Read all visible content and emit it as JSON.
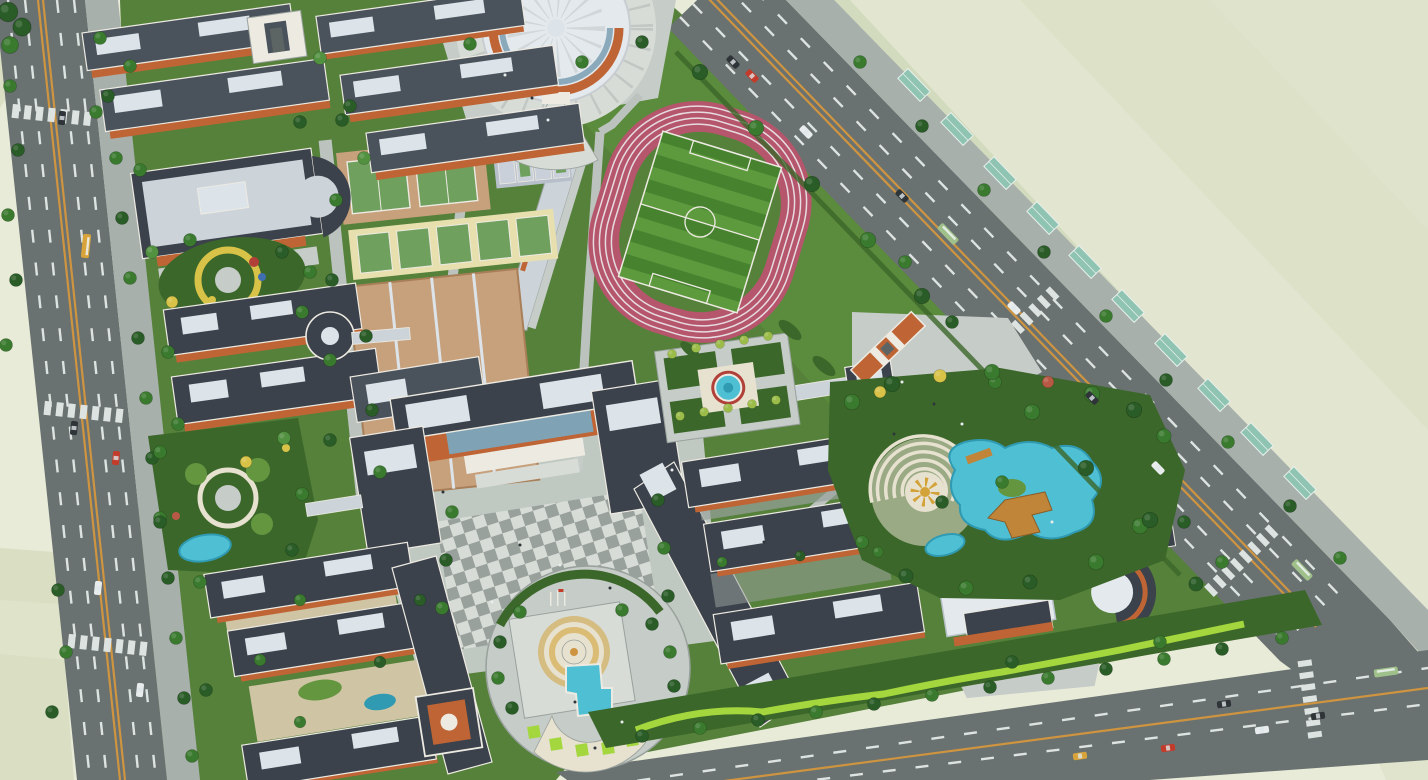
{
  "scene": {
    "type": "aerial architectural rendering",
    "subject": "school campus master plan, bird's-eye oblique view",
    "surroundings": "pale undeveloped fields beyond boundary roads",
    "visible_text": ""
  },
  "palette": {
    "field": "#e9ebd9",
    "fieldA": "#e0e4cc",
    "fieldB": "#dadfc3",
    "fieldG": "#cfd9bb",
    "grass": "#55813a",
    "grassD": "#3c672a",
    "grassB": "#649640",
    "asphalt": "#697270",
    "asphaltD": "#5c6564",
    "dash": "#dde3e0",
    "orange": "#cf9440",
    "sidewalk": "#a8b0ac",
    "sidewalkL": "#bcc3bf",
    "paving": "#c6ccc8",
    "pavingL": "#d8dcd7",
    "pavingD": "#99a19d",
    "roofD": "#3b424b",
    "roofM": "#4a525c",
    "roofL": "#ccd4da",
    "roofW": "#e4e9ed",
    "panel": "#dce3e9",
    "wall": "#bf6535",
    "wallL": "#d98e52",
    "trim": "#edeae2",
    "glass": "#7fa3b5",
    "water": "#4fc0d4",
    "waterD": "#2f9ab2",
    "track": "#b5566d",
    "laneLine": "#e6dce0",
    "pitchA": "#47822f",
    "pitchB": "#5d9a3d",
    "tan": "#c7a07c",
    "tanD": "#a87f58",
    "green": "#6fa05e",
    "blue": "#b7bfca",
    "blueL": "#c9d0da",
    "yellowC": "#e7e0ae",
    "cream": "#e7e1cf",
    "wood": "#c08538",
    "gold": "#d3a339",
    "redAcc": "#b04038",
    "hedge": "#a4d63e",
    "courtyard": "#cfc4a4",
    "bbLine": "#7c4f32",
    "tD": "#295c26",
    "tM": "#3a7a2e",
    "tL": "#529140",
    "tY": "#d8c348",
    "tYg": "#9cbc4a",
    "tR": "#b85946",
    "carR": "#c33b2a",
    "carY": "#d8a33a",
    "carW": "#e8ecec",
    "carD": "#2e3438",
    "bus": "#9fc08a",
    "gh": "#8fc4b2",
    "wht": "#f2f4f2"
  },
  "features": {
    "gymnasium": {
      "name": "round-gymnasium",
      "roof": "white dome with radial ribs",
      "facade_band": "orange"
    },
    "stadium": {
      "name": "running-track",
      "track_color_name": "red",
      "lanes": 6,
      "infield": "striped soccer pitch with white markings"
    },
    "courts": {
      "basketball_courts": 16,
      "tennis_courts": 2,
      "badminton_courts": 5,
      "small_courts": 8,
      "surfaces": {
        "basketball": "tan",
        "tennis": "green on tan apron",
        "badminton": "green on pale yellow",
        "small": "blue-gray"
      }
    },
    "buildings": {
      "style": "orange brick walls, dark slate roofs, white trim",
      "clusters": [
        "north dormitory rows",
        "north gate",
        "canteen with curved annex",
        "west teaching pair with round link",
        "main teaching complex with glass entrance",
        "east E-shaped teaching complex",
        "south dormitory cluster with clock tower",
        "southeast white-roof complex with curved wing",
        "east gate"
      ]
    },
    "gardens": [
      "kindergarten play garden",
      "clover garden with pond",
      "square garden with round pond",
      "amphitheater water garden with sun mosaic and wooden deck",
      "south circular fountain plaza",
      "south green berm with wavy hedge"
    ],
    "roads": {
      "west_road": {
        "orientation": "near-vertical",
        "center_line": "double orange",
        "lane_dashes": "white"
      },
      "northeast_road": {
        "orientation": "diagonal",
        "center_line": "double orange",
        "roadside": "row of teal shelters"
      },
      "south_road": {
        "orientation": "near-horizontal",
        "center_line": "orange"
      }
    },
    "vehicles": {
      "cars": 16,
      "buses": 5
    },
    "flagpoles": 3
  }
}
